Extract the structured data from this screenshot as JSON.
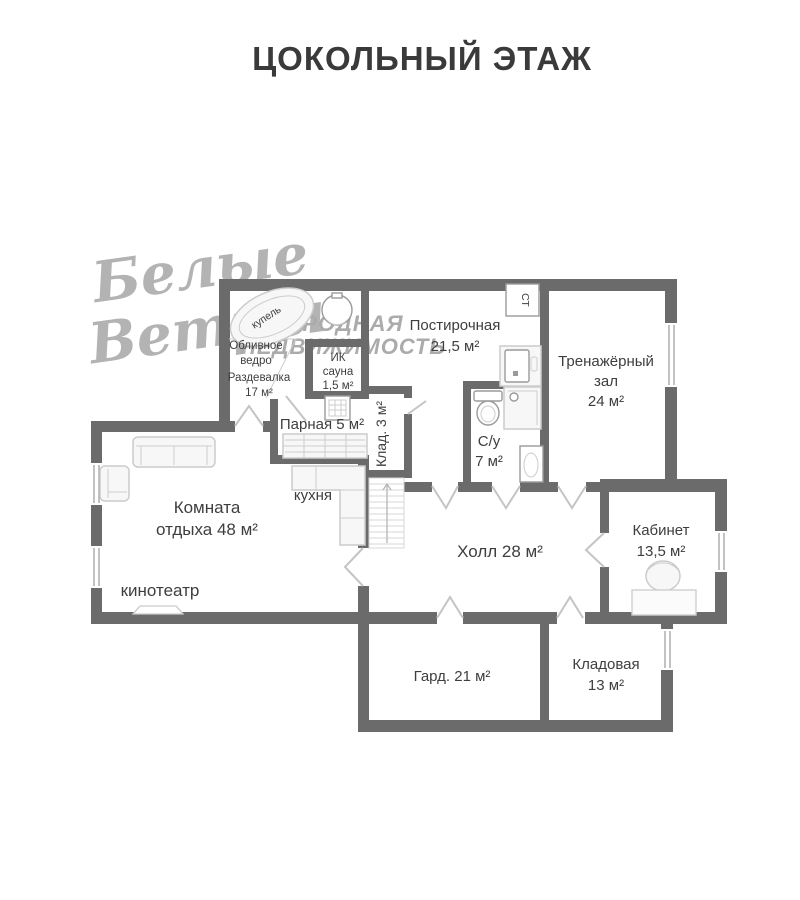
{
  "title": "ЦОКОЛЬНЫЙ ЭТАЖ",
  "watermark": {
    "script_line1": "Белые",
    "script_line2": "Ветры",
    "caps_line1": "ЗАГОРОДНАЯ",
    "caps_line2": "НЕДВИЖИМОСТЬ"
  },
  "rooms": {
    "laundry": {
      "name": "Постирочная",
      "area": "21,5 м²"
    },
    "gym": {
      "name_line1": "Тренажёрный",
      "name_line2": "зал",
      "area": "24 м²"
    },
    "dressing": {
      "name": "Раздевалка",
      "area": "17 м²"
    },
    "dousing_bucket": {
      "line1": "Обливное",
      "line2": "ведро"
    },
    "plunge_tub": {
      "name": "купель"
    },
    "ir_sauna": {
      "line1": "ИК",
      "line2": "сауна",
      "area": "1,5 м²"
    },
    "steam_room": {
      "label": "Парная 5 м²"
    },
    "small_closet": {
      "label": "Клад. 3 м²"
    },
    "kitchen": {
      "label": "кухня"
    },
    "lounge": {
      "name_line1": "Комната",
      "name_line2": "отдыха 48 м²"
    },
    "cinema": {
      "label": "кинотеатр"
    },
    "hall": {
      "label": "Холл 28 м²"
    },
    "bathroom": {
      "name": "С/у",
      "area": "7 м²"
    },
    "office": {
      "name": "Кабинет",
      "area": "13,5 м²"
    },
    "wardrobe": {
      "label": "Гард. 21 м²"
    },
    "storage": {
      "name": "Кладовая",
      "area": "13 м²"
    },
    "washer": {
      "label": "СТ"
    }
  },
  "colors": {
    "wall": "#6b6b6b",
    "title_text": "#3a3a3a",
    "label_text": "#3e3e3e",
    "watermark": "#b3b3b3",
    "door_stroke": "#c4c4c4",
    "window_line": "#9a9a9a",
    "fixture_stroke": "#cccccc",
    "fixture_fill": "#f7f7f7"
  }
}
